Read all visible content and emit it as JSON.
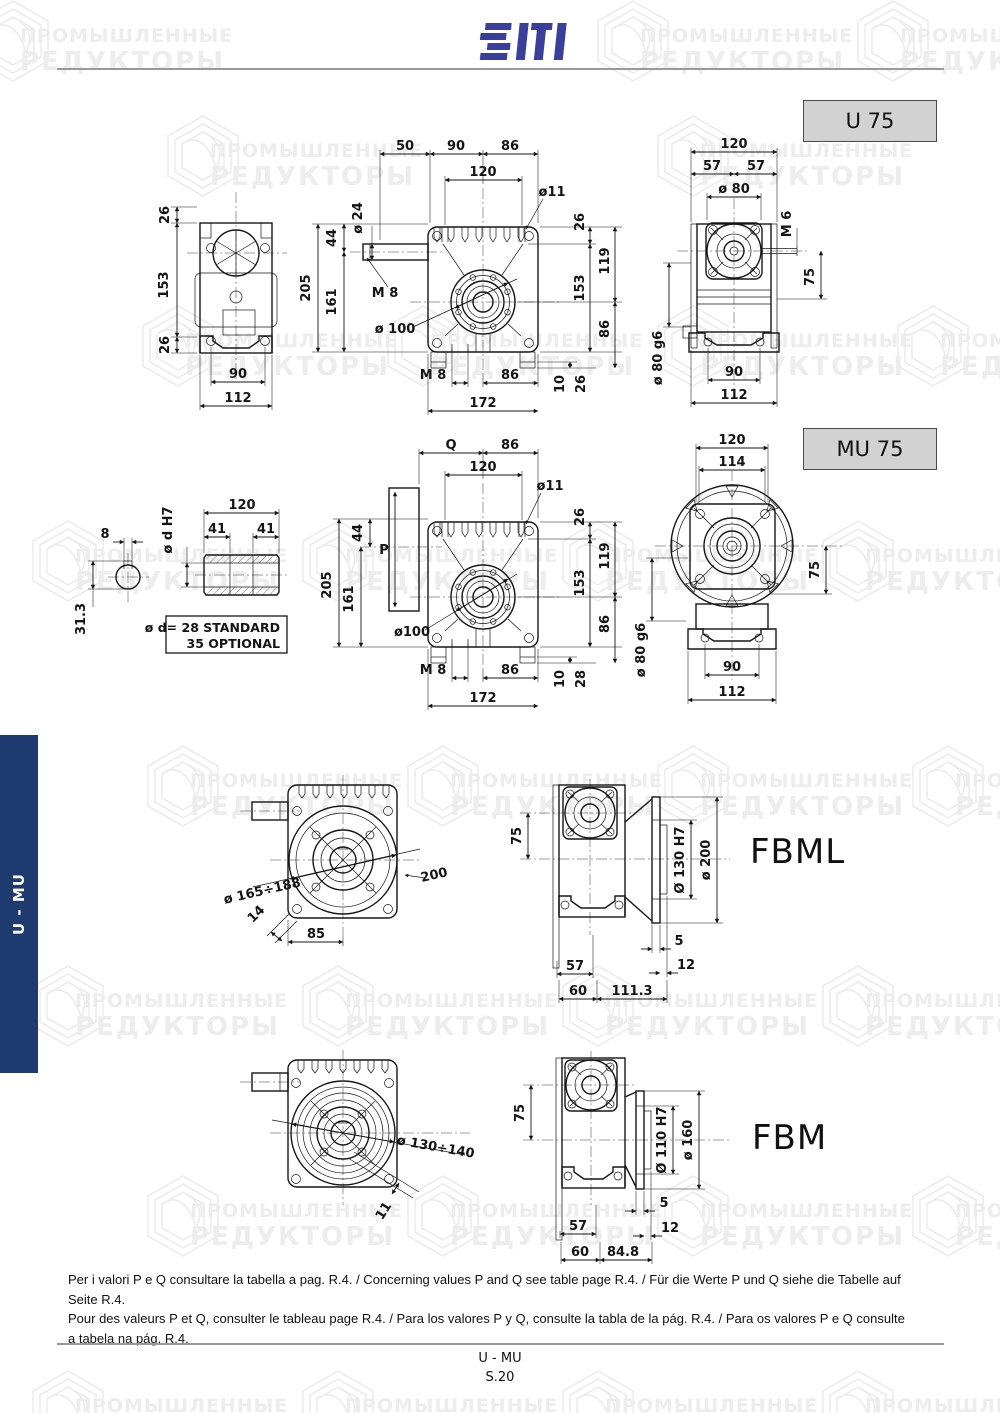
{
  "watermark": {
    "line1": "ПРОМЫШЛЕННЫЕ",
    "line2": "РЕДУКТОРЫ"
  },
  "header": {
    "logo": "SITI"
  },
  "sidebar": {
    "label": "U - MU"
  },
  "u75": {
    "label": "U 75",
    "side": {
      "t26": "26",
      "m153": "153",
      "b26": "26",
      "w90": "90",
      "w112": "112"
    },
    "front": {
      "t50": "50",
      "t90": "90",
      "t86": "86",
      "t120": "120",
      "hole": "ø11",
      "l44": "44",
      "shaft": "ø 24",
      "h205": "205",
      "h161": "161",
      "m8": "M 8",
      "flange": "ø 100",
      "bm8": "M 8",
      "b86": "86",
      "b172": "172",
      "r26": "26",
      "r119": "119",
      "r153": "153",
      "r86": "86",
      "r10": "10",
      "rb26": "26"
    },
    "back": {
      "t120": "120",
      "t57l": "57",
      "t57r": "57",
      "bore": "ø 80",
      "stud": "M 6",
      "v75": "75",
      "spigot": "ø 80 g6",
      "b90": "90",
      "b112": "112"
    }
  },
  "mu75": {
    "label": "MU 75",
    "hollow": {
      "key8": "8",
      "bore": "ø d H7",
      "t120": "120",
      "l41": "41",
      "r41": "41",
      "v313": "31.3",
      "note1": "ø d= 28 STANDARD",
      "note2": "35 OPTIONAL"
    },
    "front": {
      "q": "Q",
      "t86": "86",
      "t120": "120",
      "hole": "ø11",
      "l44": "44",
      "p": "P",
      "h205": "205",
      "h161": "161",
      "flange": "ø100",
      "bm8": "M 8",
      "b86": "86",
      "b172": "172",
      "r26": "26",
      "r119": "119",
      "r153": "153",
      "r86": "86",
      "r10": "10",
      "r28": "28"
    },
    "back": {
      "t120": "120",
      "t114": "114",
      "v75": "75",
      "spigot": "ø 80 g6",
      "b90": "90",
      "b112": "112"
    }
  },
  "fbml": {
    "label": "FBML",
    "front": {
      "bolt": "ø 165÷188",
      "ch14": "14",
      "b85": "85",
      "sq200": "200"
    },
    "side": {
      "v75": "75",
      "bore": "Ø 130 H7",
      "flange": "ø 200",
      "p5": "5",
      "p12": "12",
      "b57": "57",
      "b60": "60",
      "b1113": "111.3"
    }
  },
  "fbm": {
    "label": "FBM",
    "front": {
      "bolt": "ø 130÷140",
      "ch11": "11"
    },
    "side": {
      "v75": "75",
      "bore": "Ø 110 H7",
      "flange": "ø 160",
      "p5": "5",
      "p12": "12",
      "b57": "57",
      "b60": "60",
      "b848": "84.8"
    }
  },
  "footer": {
    "line1": "Per i valori P e Q consultare la tabella a pag. R.4. / Concerning values P and Q see table page R.4. / Für die Werte P und Q siehe die Tabelle auf Seite R.4.",
    "line2": "Pour des val­eurs P et Q, consulter le tableau page R.4. / Para los valores P y Q, consulte la tabla de la pág. R.4. / Para os valores P e Q consulte",
    "line3": "a tabela na pág. R.4.",
    "doc": "U - MU",
    "page": "S.20"
  }
}
